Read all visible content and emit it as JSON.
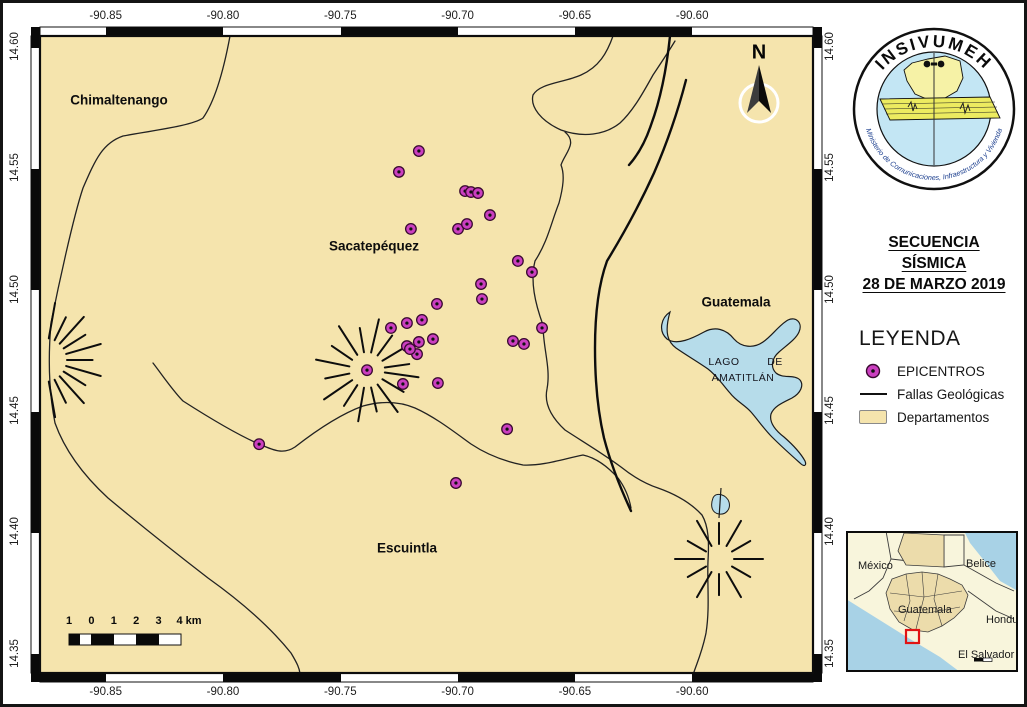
{
  "colors": {
    "land": "#f5e4ad",
    "water": "#b6dcea",
    "epicenter": "#cb3fc0",
    "epicenter_edge": "#38092f",
    "fault": "#0d0d0d",
    "boundary": "#222222",
    "inset_land": "#f8f5dc",
    "inset_depts": "#ecdcab",
    "inset_water": "#a8d2e6",
    "red_box": "#e11414",
    "logo_blue": "#c3e6f4",
    "logo_yellow": "#f6f2a6",
    "logo_band": "#eceb60",
    "ministry_text": "#1b3e8e"
  },
  "map": {
    "extent": {
      "lon_min": -90.878,
      "lon_max": -90.5485,
      "lat_min": 14.3425,
      "lat_max": 14.605
    },
    "lon_ticks": [
      "-90.85",
      "-90.80",
      "-90.75",
      "-90.70",
      "-90.65",
      "-90.60"
    ],
    "lat_ticks": [
      "14.60",
      "14.55",
      "14.50",
      "14.45",
      "14.40",
      "14.35"
    ],
    "north_label": "N",
    "labels": {
      "chimaltenango": "Chimaltenango",
      "sacatepequez": "Sacatepéquez",
      "guatemala": "Guatemala",
      "escuintla": "Escuintla",
      "lago": "LAGO",
      "lago_de": "DE",
      "amatitlan": "AMATITLÁN"
    },
    "scalebar": {
      "labels": [
        "1",
        "0",
        "1",
        "2",
        "3",
        "4 km"
      ]
    },
    "epicenters": [
      [
        -90.7165,
        14.5576
      ],
      [
        -90.725,
        14.549
      ],
      [
        -90.6968,
        14.5411
      ],
      [
        -90.6943,
        14.5407
      ],
      [
        -90.6913,
        14.5403
      ],
      [
        -90.6862,
        14.5312
      ],
      [
        -90.6998,
        14.5255
      ],
      [
        -90.696,
        14.5275
      ],
      [
        -90.7199,
        14.5255
      ],
      [
        -90.6743,
        14.5123
      ],
      [
        -90.6683,
        14.5077
      ],
      [
        -90.69,
        14.5028
      ],
      [
        -90.6896,
        14.4966
      ],
      [
        -90.7088,
        14.4946
      ],
      [
        -90.7284,
        14.4847
      ],
      [
        -90.7216,
        14.4867
      ],
      [
        -90.7152,
        14.488
      ],
      [
        -90.7216,
        14.4772
      ],
      [
        -90.7165,
        14.4789
      ],
      [
        -90.7105,
        14.4801
      ],
      [
        -90.7173,
        14.4739
      ],
      [
        -90.7203,
        14.476
      ],
      [
        -90.7386,
        14.4673
      ],
      [
        -90.7233,
        14.4616
      ],
      [
        -90.7084,
        14.462
      ],
      [
        -90.6764,
        14.4793
      ],
      [
        -90.6717,
        14.4781
      ],
      [
        -90.664,
        14.4847
      ],
      [
        -90.6789,
        14.443
      ],
      [
        -90.7007,
        14.4208
      ],
      [
        -90.7846,
        14.4368
      ]
    ]
  },
  "logo": {
    "name": "INSIVUMEH",
    "ministry": "Ministerio de Comunicaciones, Infraestructura y Vivienda"
  },
  "title": {
    "line1": "SECUENCIA",
    "line2": "SÍSMICA",
    "line3": "28 DE MARZO 2019"
  },
  "legend": {
    "heading": "LEYENDA",
    "items": [
      {
        "label": "EPICENTROS"
      },
      {
        "label": "Fallas Geológicas"
      },
      {
        "label": "Departamentos"
      }
    ]
  },
  "inset": {
    "labels": {
      "mexico": "México",
      "belice": "Belice",
      "guatemala": "Guatemala",
      "honduras": "Honduras",
      "el_salvador": "El Salvador"
    }
  }
}
